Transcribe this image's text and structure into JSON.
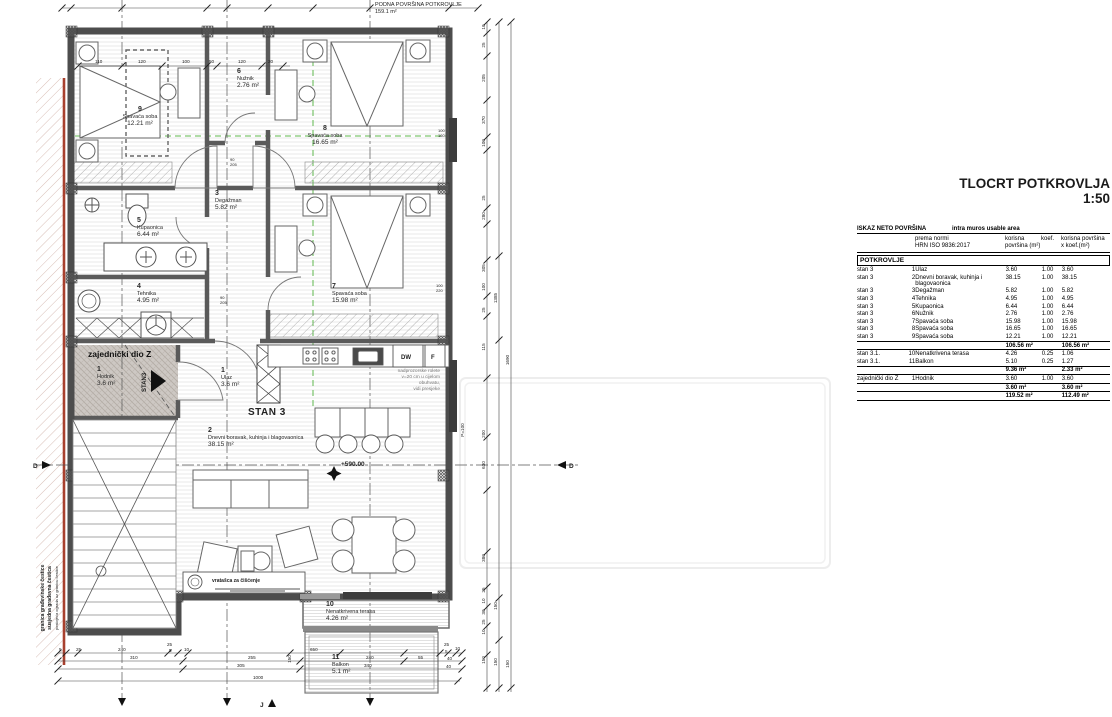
{
  "title": {
    "main": "TLOCRT POTKROVLJA",
    "scale": "1:50"
  },
  "plan": {
    "floor_note": {
      "line1": "PODNA POVRŠINA POTKROVLJE",
      "line2": "159.1 m²"
    },
    "stan_big": "STAN 3",
    "stan_small": "STAN3",
    "zajednicki": "zajednički dio Z",
    "elevation": "+590.00",
    "p_label": "P=100",
    "kitchen": {
      "dw": "DW",
      "f": "F"
    },
    "cleaning_note": "vratašca za čišćenje",
    "rolete": {
      "l1": "nadprozorske rolete",
      "l2": "v=20 cm u cijelom",
      "l3": "obuhvatu,",
      "l4": "vidi presjeke"
    },
    "boundary": {
      "l1": "granica građevinske čestice",
      "l2": "susjedna građevna čestica",
      "l3": "postojeća ograda uz granicu čestice"
    },
    "sections": {
      "left": "D",
      "right": "D",
      "bottom": "J"
    },
    "rooms": [
      {
        "num": "9",
        "name": "Spavaća soba",
        "area": "12.21 m²"
      },
      {
        "num": "6",
        "name": "Nužnik",
        "area": "2.76 m²"
      },
      {
        "num": "8",
        "name": "Spavaća soba",
        "area": "16.65 m²"
      },
      {
        "num": "3",
        "name": "Degažman",
        "area": "5.82 m²"
      },
      {
        "num": "5",
        "name": "Kupaonica",
        "area": "6.44 m²"
      },
      {
        "num": "4",
        "name": "Tehnika",
        "area": "4.95 m²"
      },
      {
        "num": "7",
        "name": "Spavaća soba",
        "area": "15.98 m²"
      },
      {
        "num": "1",
        "name": "Hodnik",
        "area": "3.6 m²"
      },
      {
        "num": "1",
        "name": "Ulaz",
        "area": "3.6 m²"
      },
      {
        "num": "2",
        "name": "Dnevni boravak, kuhinja i blagovaonica",
        "area": "38.15 m²"
      },
      {
        "num": "10",
        "name": "Nenatkrivena terasa",
        "area": "4.26 m²"
      },
      {
        "num": "11",
        "name": "Balkon",
        "area": "5.1 m²"
      }
    ],
    "dims": {
      "interior": [
        "110",
        "120",
        "100",
        "50",
        "120",
        "20"
      ],
      "right": [
        "10",
        "25",
        "205",
        "370",
        "100",
        "25",
        "280",
        "305",
        "100",
        "25",
        "115",
        "200",
        "630",
        "380",
        "25",
        "10",
        "30",
        "25",
        "10",
        "150",
        "1385",
        "150",
        "150",
        "1690",
        "150"
      ],
      "bottom": [
        "5",
        "25",
        "240",
        "25",
        "5",
        "10",
        "650",
        "310",
        "255",
        "240",
        "55",
        "305",
        "340",
        "1000",
        "25",
        "5",
        "10",
        "40",
        "40",
        "150"
      ],
      "doors": [
        "90",
        "205",
        "90",
        "205",
        "100",
        "160",
        "100",
        "220"
      ]
    }
  },
  "table": {
    "header_left": "ISKAZ NETO POVRŠINA",
    "header_right": "intra muros usable area",
    "col_norm1": "prema normi",
    "col_norm2": "HRN ISO 9836:2017",
    "col_area1": "korisna",
    "col_area2": "površina (m²)",
    "col_koef": "koef.",
    "col_areakoef1": "korisna površina",
    "col_areakoef2": "x koef.(m²)",
    "section": "POTKROVLJE",
    "rows": [
      {
        "g": "stan 3",
        "n": "1",
        "d": "Ulaz",
        "a": "3.60",
        "k": "1.00",
        "x": "3.60",
        "c": ""
      },
      {
        "g": "stan 3",
        "n": "2",
        "d": "Dnevni boravak, kuhinja i blagovaonica",
        "a": "38.15",
        "k": "1.00",
        "x": "38.15",
        "c": ""
      },
      {
        "g": "stan 3",
        "n": "3",
        "d": "Degažman",
        "a": "5.82",
        "k": "1.00",
        "x": "5.82",
        "c": ""
      },
      {
        "g": "stan 3",
        "n": "4",
        "d": "Tehnika",
        "a": "4.95",
        "k": "1.00",
        "x": "4.95",
        "c": ""
      },
      {
        "g": "stan 3",
        "n": "5",
        "d": "Kupaonica",
        "a": "6.44",
        "k": "1.00",
        "x": "6.44",
        "c": ""
      },
      {
        "g": "stan 3",
        "n": "6",
        "d": "Nužnik",
        "a": "2.76",
        "k": "1.00",
        "x": "2.76",
        "c": ""
      },
      {
        "g": "stan 3",
        "n": "7",
        "d": "Spavaća soba",
        "a": "15.98",
        "k": "1.00",
        "x": "15.98",
        "c": ""
      },
      {
        "g": "stan 3",
        "n": "8",
        "d": "Spavaća soba",
        "a": "16.65",
        "k": "1.00",
        "x": "16.65",
        "c": ""
      },
      {
        "g": "stan 3",
        "n": "9",
        "d": "Spavaća soba",
        "a": "12.21",
        "k": "1.00",
        "x": "12.21",
        "c": ""
      },
      {
        "g": "",
        "n": "",
        "d": "",
        "a": "106.56 m²",
        "k": "",
        "x": "106.56 m²",
        "c": "subtotal"
      },
      {
        "g": "stan 3.1.",
        "n": "10",
        "d": "Nenatkrivena terasa",
        "a": "4.26",
        "k": "0.25",
        "x": "1.06",
        "c": "sep"
      },
      {
        "g": "stan 3.1.",
        "n": "11",
        "d": "Balkon",
        "a": "5.10",
        "k": "0.25",
        "x": "1.27",
        "c": ""
      },
      {
        "g": "",
        "n": "",
        "d": "",
        "a": "9.36 m²",
        "k": "",
        "x": "2.33 m²",
        "c": "subtotal"
      },
      {
        "g": "zajednički dio Z",
        "n": "1",
        "d": "Hodnik",
        "a": "3.60",
        "k": "1.00",
        "x": "3.60",
        "c": "sep"
      },
      {
        "g": "",
        "n": "",
        "d": "",
        "a": "3.60 m²",
        "k": "",
        "x": "3.60 m²",
        "c": "subtotal"
      },
      {
        "g": "",
        "n": "",
        "d": "",
        "a": "119.52 m²",
        "k": "",
        "x": "112.49 m²",
        "c": "total"
      }
    ]
  },
  "colors": {
    "accent_green": "#5fb94e",
    "boundary_red": "#a8402e",
    "wall": "#4d4d4d"
  }
}
